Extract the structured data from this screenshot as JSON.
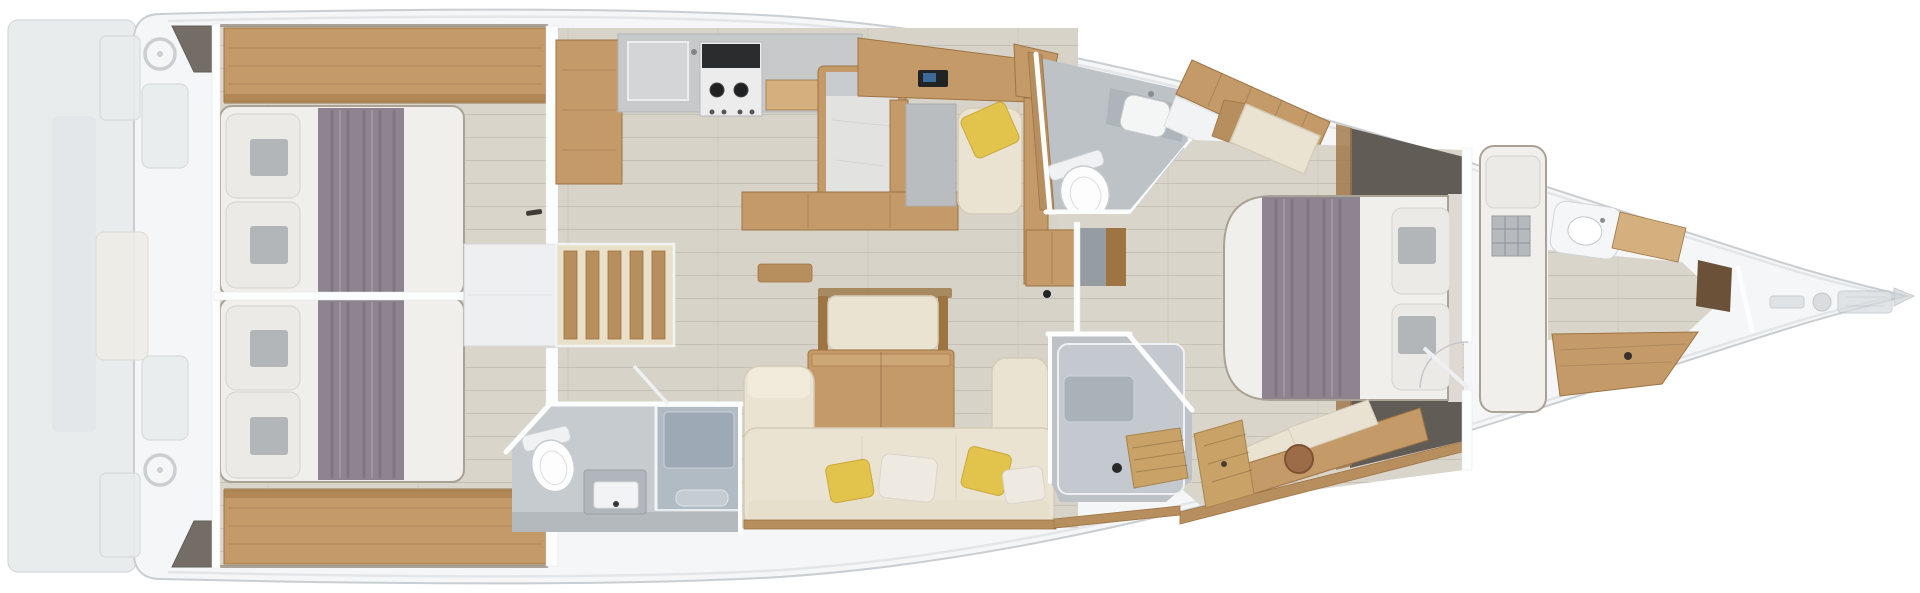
{
  "meta": {
    "view": "overhead-floor-plan",
    "orientation": "bow-right"
  },
  "colors": {
    "hull": "#f4f6f7",
    "hull_line": "#c9ced2",
    "deck_line": "#e3e6e9",
    "bg": "#ffffff",
    "floor": "#d7d3c9",
    "floor_cabin": "#dad5ca",
    "wood": "#c49a69",
    "wood_dark": "#9e7443",
    "wood_mid": "#b78e5d",
    "wood_light": "#d3b07e",
    "teak": "#c8a266",
    "counter": "#c7c9ca",
    "island": "#e2e3e1",
    "stove": "#2b2c2e",
    "mattress": "#f1efeb",
    "pillow": "#eceae7",
    "pillow_sq": "#b3b6b9",
    "runner": "#8e8490",
    "sofa": "#ebe3d1",
    "sofa_trim": "#a07c4e",
    "yellow": "#e2c34b",
    "bath": "#bcc2c6",
    "bath2": "#c6cbcf",
    "shower": "#b1bbc4",
    "wall": "#fcfdfd",
    "ghost": "#e9eced",
    "ghost_line": "#d3d8db",
    "dark_panel": "#615c55",
    "dark_wedge": "#5d564d",
    "fixture": "#fdfdfd"
  },
  "areas": {
    "swim_platform": {
      "label": "Fold-down swim platform"
    },
    "cockpit": {
      "label": "Cockpit with twin helm wheels, benches and table"
    },
    "aft_cabin_port": {
      "label": "Aft double cabin, port side"
    },
    "aft_cabin_starboard": {
      "label": "Aft double cabin, starboard side"
    },
    "companionway": {
      "label": "Companionway steps"
    },
    "galley": {
      "label": "Galley with sink, two-burner stove and island counter"
    },
    "nav_station": {
      "label": "Chart table and navigation seat"
    },
    "day_head": {
      "label": "Mid-ship head with toilet and washbasin"
    },
    "aft_head": {
      "label": "Aft head with toilet, washbasin and shower"
    },
    "salon": {
      "label": "Salon with U-shaped settee, folding table and bench"
    },
    "ensuite_shower": {
      "label": "Owner's shower room with teak bench"
    },
    "master_cabin": {
      "label": "Owner's cabin with island double berth and vanity"
    },
    "forepeak_cabin": {
      "label": "Forepeak cabin with single berth and washbasin"
    },
    "bow_deck": {
      "label": "Bow deck with anchor windlass"
    }
  }
}
